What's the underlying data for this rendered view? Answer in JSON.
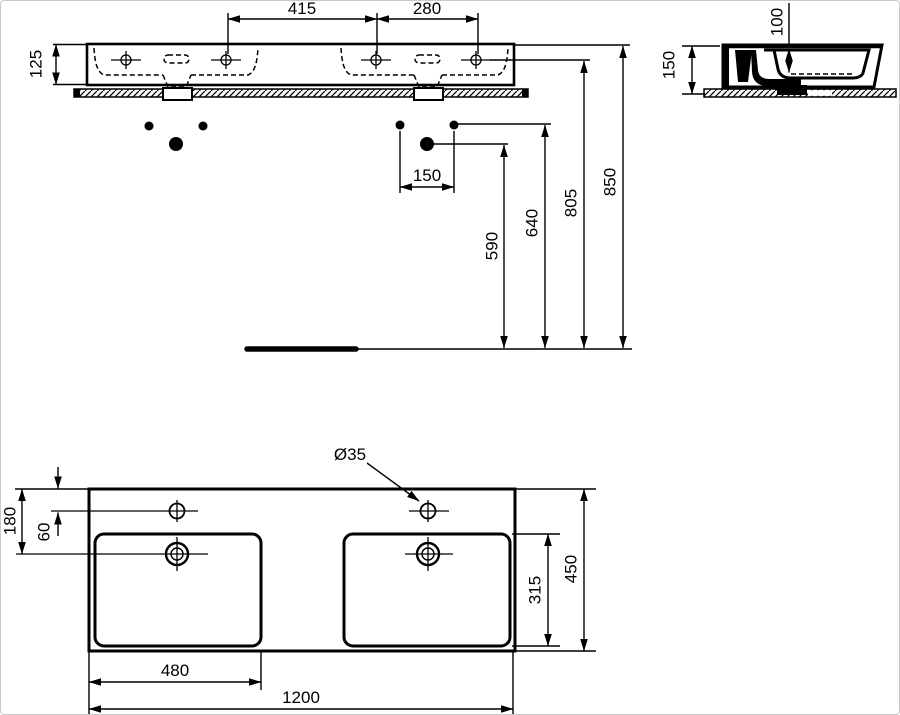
{
  "front_view": {
    "dim_tap_spacing_left": "415",
    "dim_tap_spacing_right": "280",
    "dim_rim_height_front": "125",
    "dim_fixing_hole_spacing": "150",
    "dim_floor_to_drain_fixing": "590",
    "dim_floor_to_fixing_holes": "640",
    "dim_floor_to_tap_holes": "805",
    "dim_floor_to_rim": "850"
  },
  "side_view": {
    "dim_rim_height": "150",
    "dim_bowl_depth": "100"
  },
  "plan_view": {
    "dim_rear_to_drain": "180",
    "dim_rear_to_tap": "60",
    "dim_tap_hole_diameter": "Ø35",
    "dim_bowl_inner_depth": "315",
    "dim_overall_depth": "450",
    "dim_bowl_width": "480",
    "dim_overall_width": "1200"
  },
  "colors": {
    "line": "#000000",
    "background": "#ffffff"
  }
}
